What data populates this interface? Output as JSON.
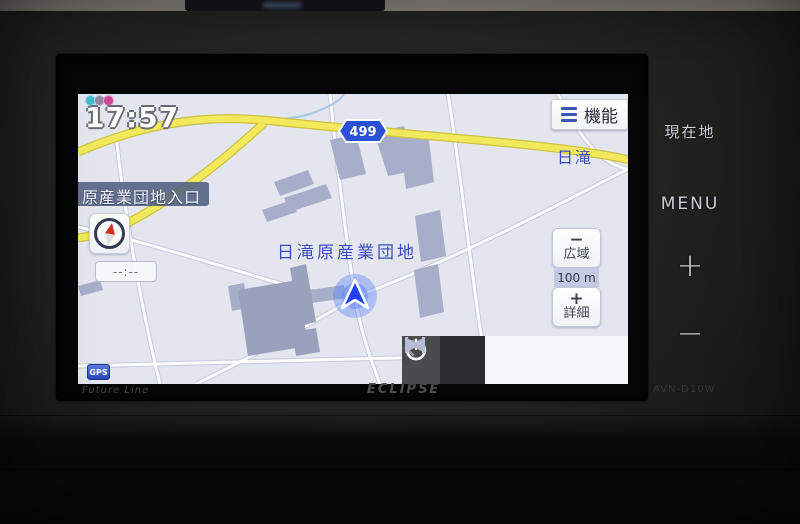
{
  "device": {
    "brand_logo": "ECLIPSE",
    "series_logo": "Future Line",
    "model_label": "AVN-D10W",
    "hard_buttons": [
      {
        "id": "current-location",
        "label": "現在地"
      },
      {
        "id": "menu",
        "label": "MENU"
      },
      {
        "id": "zoom-in-hard",
        "label": "+"
      },
      {
        "id": "zoom-out-hard",
        "label": "−"
      }
    ]
  },
  "nav_screen": {
    "clock": "17:57",
    "status_icons": [
      "vics-teal-icon",
      "vics-gray-icon",
      "vics-pink-icon"
    ],
    "function_button_label": "機能",
    "road_entrance_label": "原産業団地入口",
    "map_area_label": "日滝原産業団地",
    "map_area_label_right": "日滝",
    "route_shield_number": "499",
    "eta_placeholder": "--:--",
    "gps_badge": "GPS",
    "scale": {
      "zoom_out_symbol": "−",
      "zoom_out_label": "広域",
      "value": "100 m",
      "zoom_in_symbol": "+",
      "zoom_in_label": "詳細"
    },
    "bottom_bar": {
      "back_symbol": "‹",
      "buttons": [
        "back",
        "power",
        "skip-back",
        "skip-forward"
      ]
    },
    "colors": {
      "map_background": "#e3e6ef",
      "major_road": "#f1e85b",
      "minor_road": "#fcfcfe",
      "building": "#a7aec9",
      "map_label_text": "#3a4cc0",
      "route_shield_blue": "#2a50d8",
      "vehicle_marker_blue": "#2244ee"
    }
  }
}
